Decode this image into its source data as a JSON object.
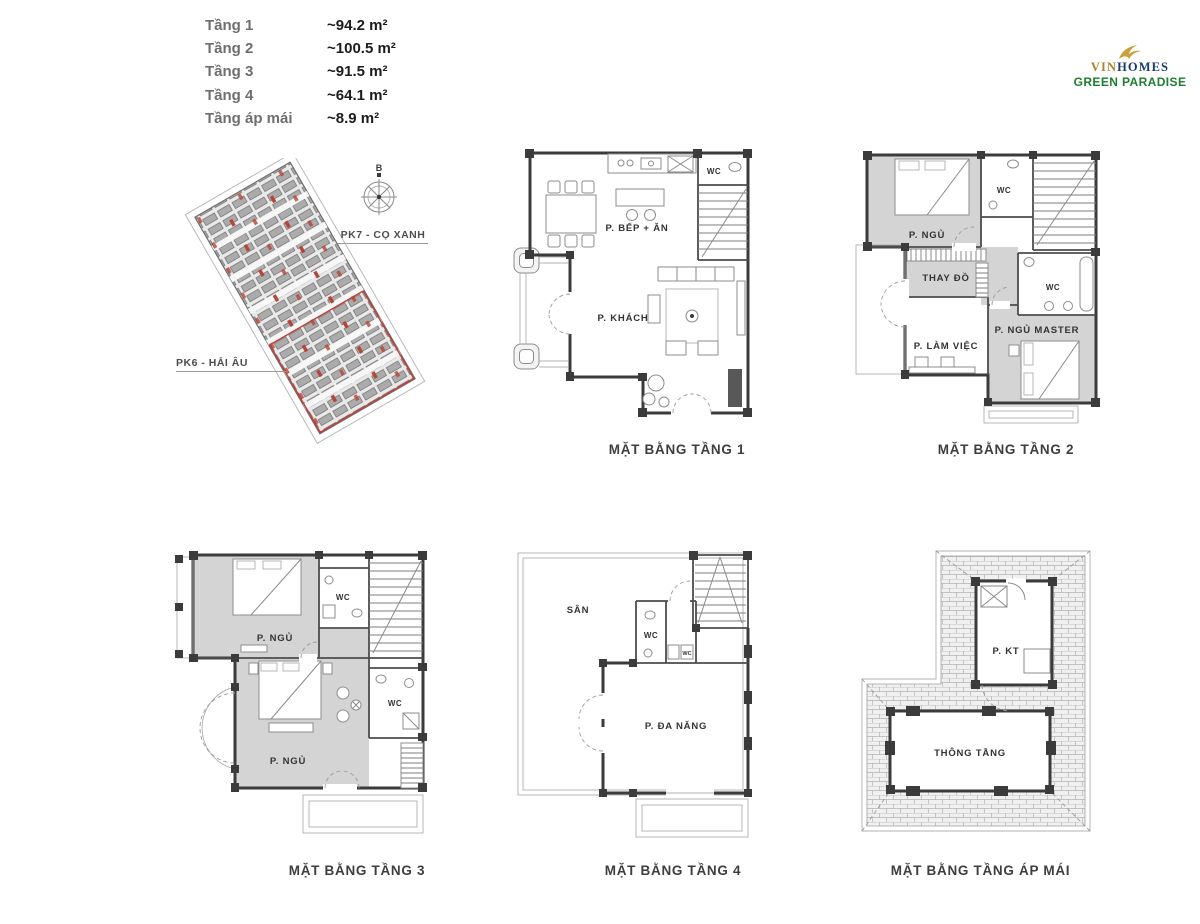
{
  "legend": {
    "rows": [
      {
        "label": "Tầng 1",
        "area": "~94.2 m²"
      },
      {
        "label": "Tầng 2",
        "area": "~100.5 m²"
      },
      {
        "label": "Tầng 3",
        "area": "~91.5 m²"
      },
      {
        "label": "Tầng 4",
        "area": "~64.1 m²"
      },
      {
        "label": "Tầng áp mái",
        "area": "~8.9 m²"
      }
    ]
  },
  "logo": {
    "brand_prefix": "VIN",
    "brand_suffix": "HOMES",
    "project": "GREEN PARADISE"
  },
  "site_plan": {
    "compass_label": "B",
    "zone_top_label": "PK7 - CỌ XANH",
    "zone_bottom_label": "PK6 - HẢI ÂU"
  },
  "floor_plans": {
    "tang1": {
      "caption": "MẶT BẰNG TẦNG 1",
      "rooms": {
        "kitchen_dining": "P. BẾP + ĂN",
        "living": "P. KHÁCH",
        "wc": "WC"
      }
    },
    "tang2": {
      "caption": "MẶT BẰNG TẦNG 2",
      "rooms": {
        "bedroom": "P. NGỦ",
        "wc_top": "WC",
        "dressing": "THAY ĐỒ",
        "wc_master": "WC",
        "office": "P. LÀM VIỆC",
        "master_bedroom": "P. NGỦ MASTER"
      }
    },
    "tang3": {
      "caption": "MẶT BẰNG TẦNG 3",
      "rooms": {
        "bedroom_top": "P. NGỦ",
        "wc_top": "WC",
        "bedroom_main": "P. NGỦ",
        "wc_side": "WC"
      }
    },
    "tang4": {
      "caption": "MẶT BẰNG TẦNG 4",
      "rooms": {
        "terrace": "SÂN",
        "wc": "WC",
        "wc_small": "WC",
        "multipurpose": "P. ĐA NĂNG"
      }
    },
    "ap_mai": {
      "caption": "MẶT BẰNG TẦNG ÁP MÁI",
      "rooms": {
        "technical": "P. KT",
        "void": "THÔNG TẦNG"
      }
    }
  },
  "colors": {
    "accent_red": "#b5453a",
    "logo_gold": "#c9a03b",
    "logo_navy": "#1d3b6d",
    "logo_green": "#1e7d2f",
    "room_shade": "#d4d4d4",
    "wall": "#3b3b3b"
  }
}
